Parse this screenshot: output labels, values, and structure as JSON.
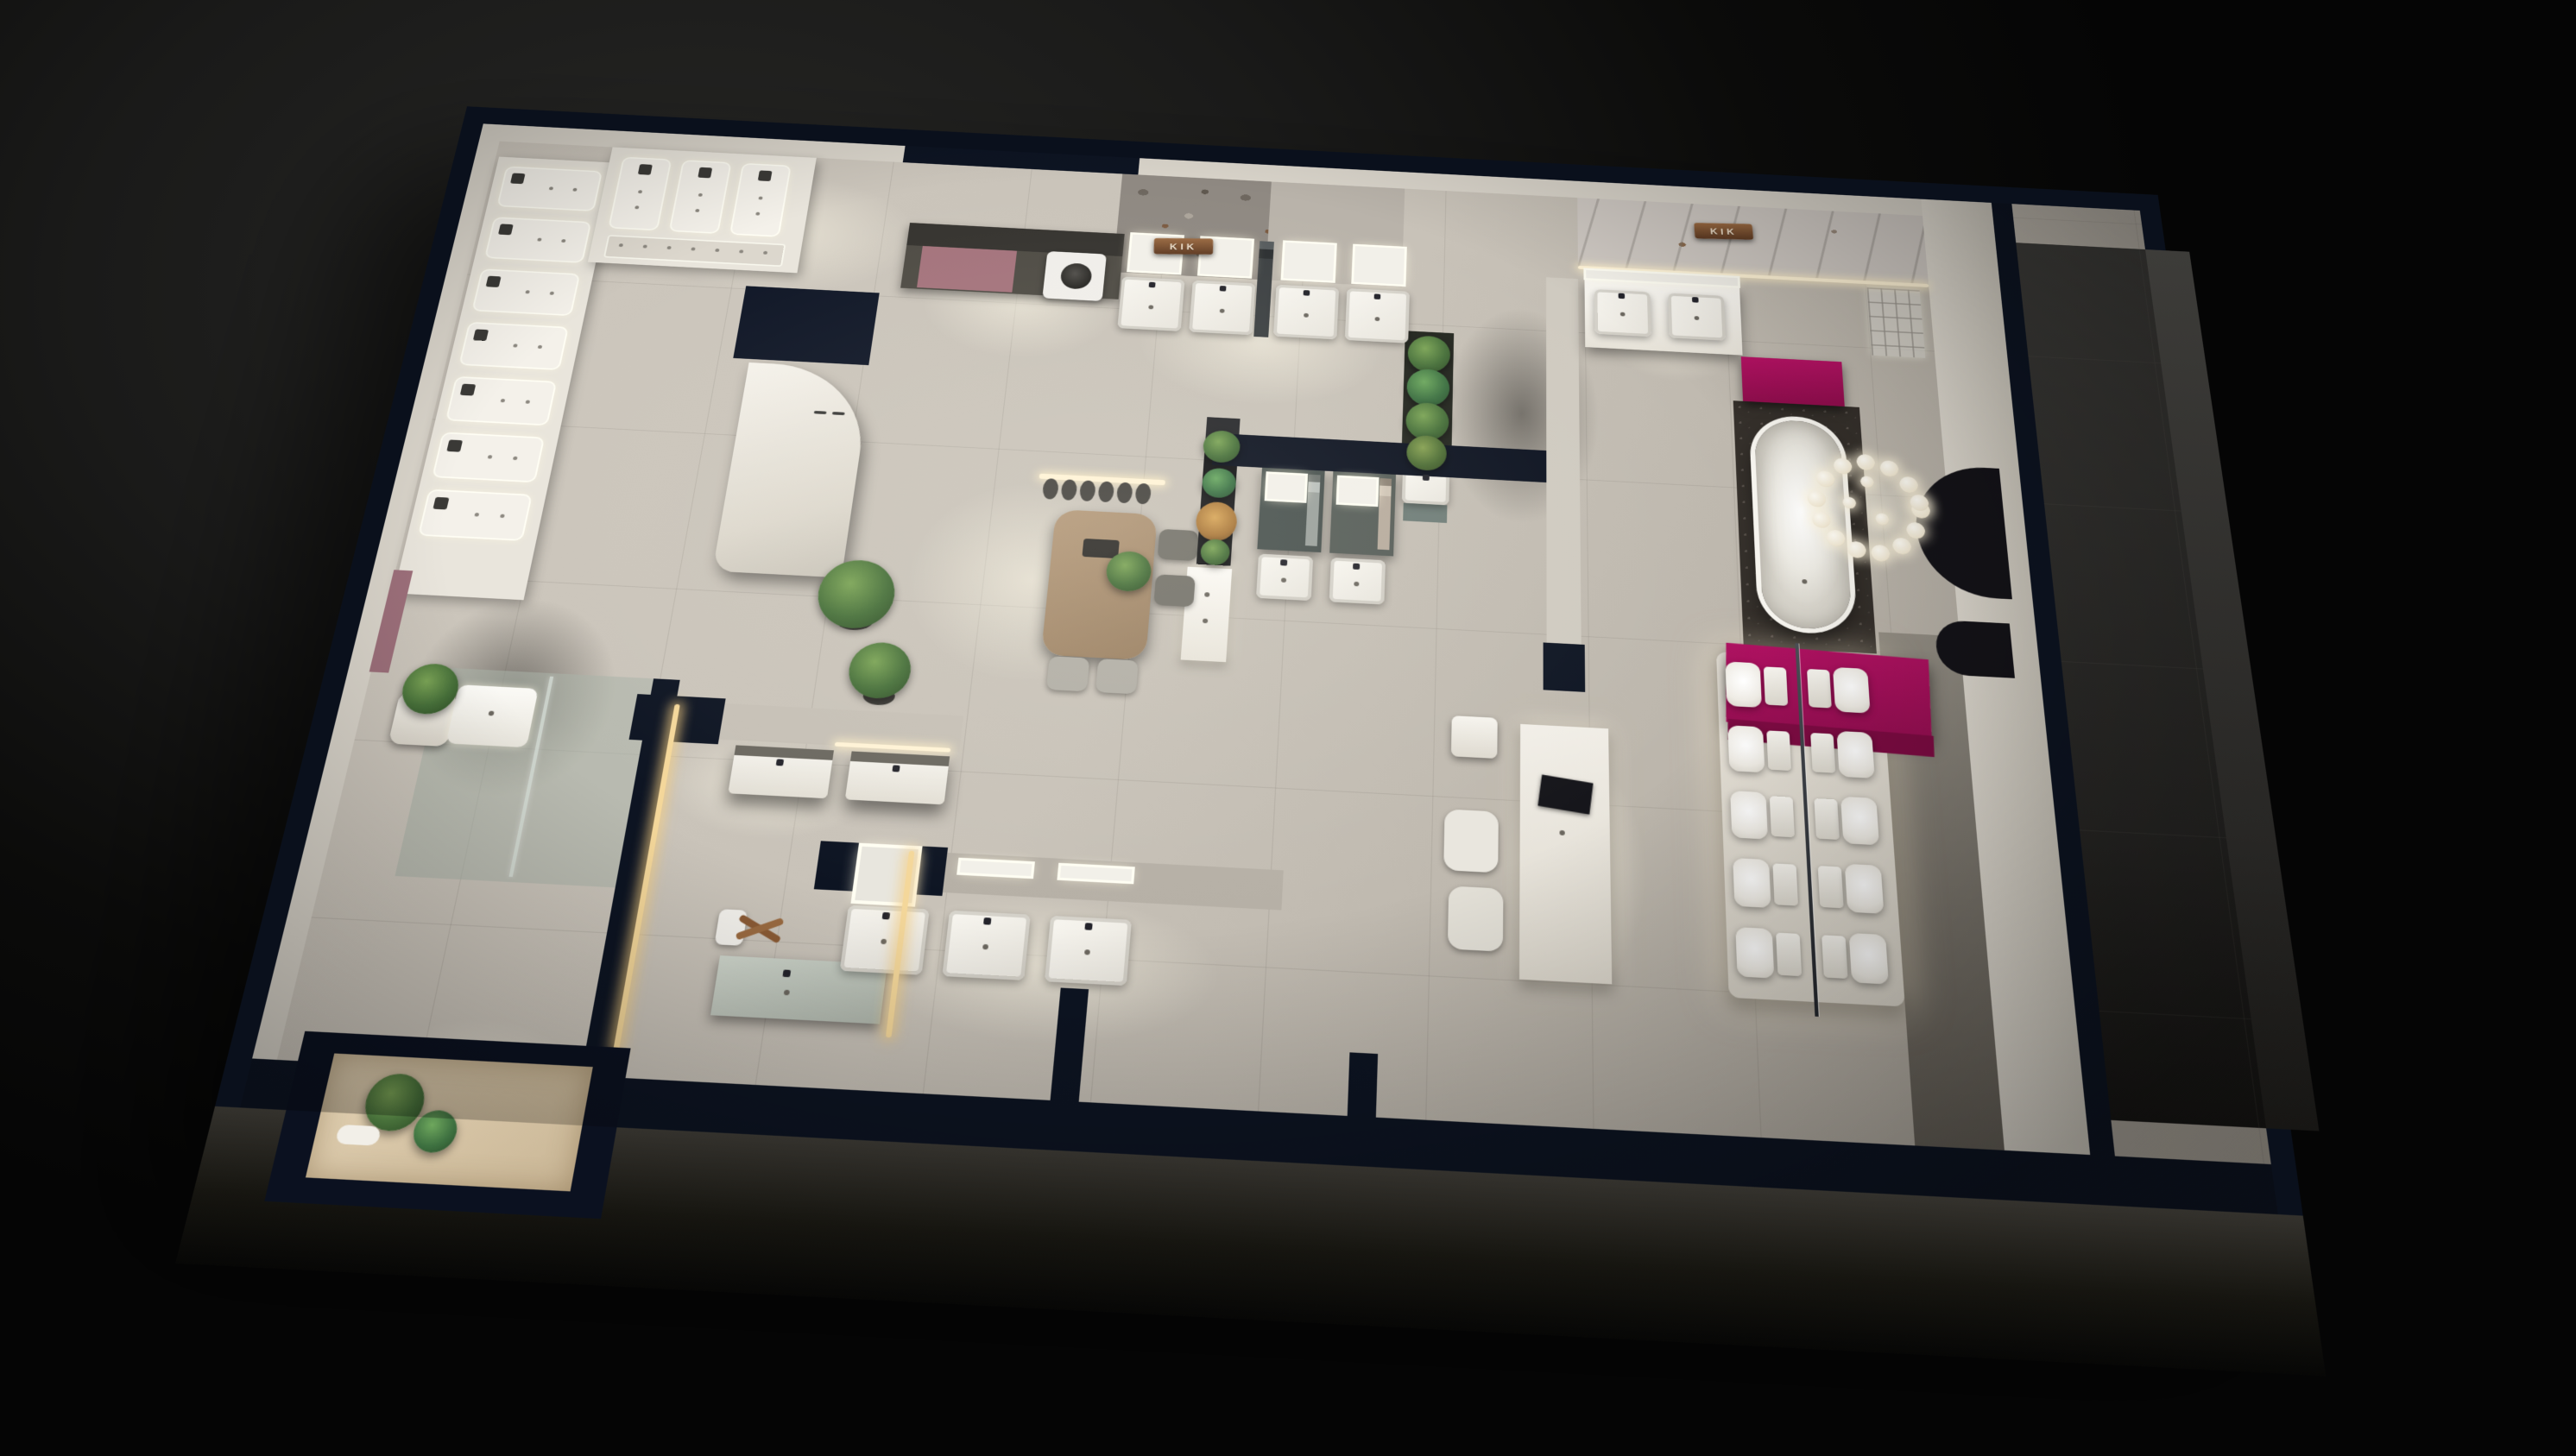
{
  "scene": {
    "type": "3d-floorplan-render",
    "setting": "Night-time bird's-eye 3D render of a sanitary-ware showroom",
    "brand": "KIK"
  },
  "palette": {
    "background": "#161616",
    "floor": "#c8c2b8",
    "wall_top": "#0d1422",
    "wall_face": "#d9d4ca",
    "stone_wall": "#8f8982",
    "marble_wall": "#cfc9c3",
    "accent_magenta": "#a50f58",
    "copper_sign": "#8a5a36",
    "wood": "#a8896a",
    "foliage": "#4d7a38",
    "led_warm": "#fff3d6"
  },
  "signs": [
    {
      "label": "KIK"
    },
    {
      "label": "KIK"
    }
  ],
  "inventory": {
    "shower_display_panels": 10,
    "vanity_units": 11,
    "wall_hung_basins": 3,
    "double_sink_vanities": 1,
    "freestanding_bathtubs": 1,
    "toilets_on_display": 10,
    "washing_machines": 1,
    "dining_chairs": 4,
    "bubble_chandeliers": 1,
    "plants": 10
  }
}
